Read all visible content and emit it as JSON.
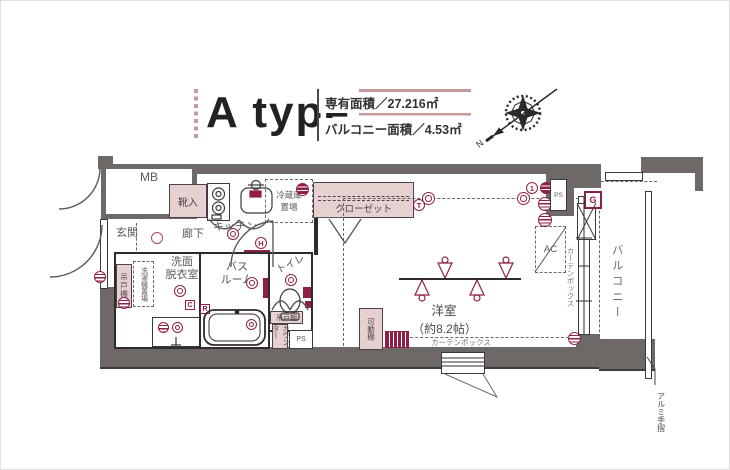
{
  "header": {
    "type_label": "A type",
    "area_line1": "専有面積／27.216㎡",
    "area_line2": "バルコニー面積／4.53㎡"
  },
  "compass": {
    "north_label": "N"
  },
  "floorplan": {
    "mb": "MB",
    "genkan": "玄関",
    "shoe_cabinet": "靴入",
    "hallway": "廊下",
    "kitchen": "キッチン",
    "fridge_line1": "冷蔵庫",
    "fridge_line2": "置場",
    "closet": "クローゼット",
    "washroom_line1": "洗面",
    "washroom_line2": "脱衣室",
    "hanging_cupboard_1": "吊戸棚",
    "laundry_space": "洗濯機置場",
    "bathroom_line1": "バス",
    "bathroom_line2": "ルーム",
    "toilet": "トイレ",
    "hanging_cupboard_2": "吊戸棚",
    "counter": "カウンター",
    "western_room_line1": "洋室",
    "western_room_line2": "（約8.2帖）",
    "movable_shelf": "可動棚",
    "curtain_box_right": "カーテンボックス",
    "curtain_box_bottom": "カーテンボックス",
    "balcony": "バルコニー",
    "aluminum_handrail": "アルミ手摺",
    "ac_unit": "AC",
    "ps_top": "PS",
    "ps_bottom": "PS"
  },
  "symbols": {
    "closet_t": "T",
    "kitchen_h": "H",
    "gas_meter_g": "G",
    "bath_c": "C",
    "bath_r": "R",
    "intercom_1": "1"
  },
  "colors": {
    "wall": "#6e6866",
    "accent": "#8f1f45",
    "pink_fill": "#e7d0d0",
    "stripe": "#c49c9c"
  }
}
